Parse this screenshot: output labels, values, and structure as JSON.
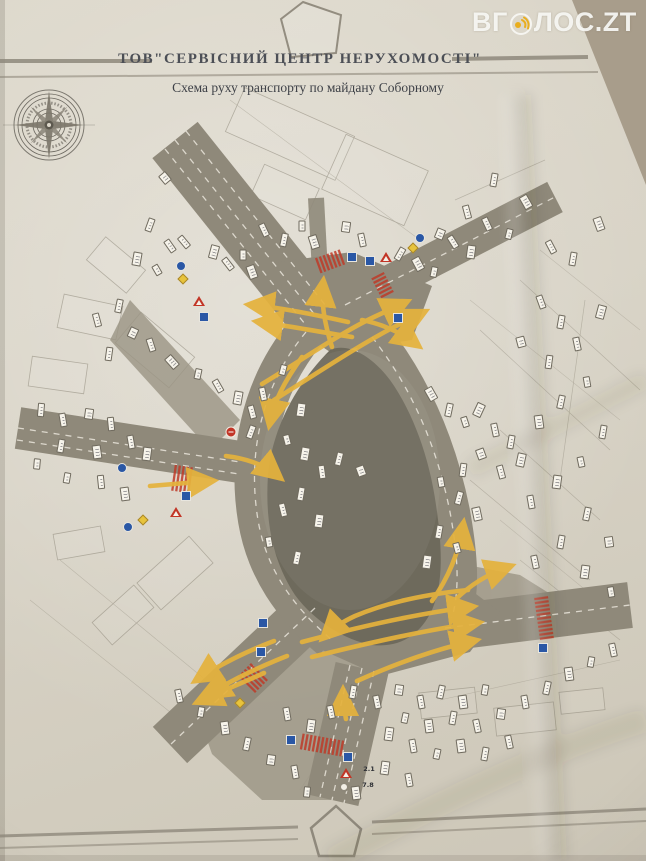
{
  "watermark": {
    "text_prefix": "ВГ",
    "text_suffix": "ЛОС.ZT",
    "icon": "megaphone-waves-icon",
    "text_color": "#f2f1ee",
    "icon_color": "#e9ae1e"
  },
  "header": {
    "company": "ТОВ\"СЕРВІСНИЙ ЦЕНТР НЕРУХОМОСТІ\"",
    "subtitle": "Схема руху транспорту по майдану Соборному"
  },
  "decorations": {
    "top_logo": "house-outline-icon",
    "bottom_logo": "house-outline-icon",
    "compass": "compass-rose-icon"
  },
  "colors": {
    "paper": "#d8d3c6",
    "paper-edge": "#a89d8b",
    "road": "#8f897a",
    "island": "#6e6a5c",
    "arrow": "#e5b23d",
    "crosswalk": "#bf3a28",
    "ink": "#4c4f56",
    "line": "#8d8779",
    "sign-blue": "#2a57a5",
    "sign-red": "#c23526",
    "sign-yellow": "#e7c33c",
    "marker-face": "#f6f3ea",
    "marker-edge": "#6f6a5e"
  },
  "map": {
    "readable_labels": [
      {
        "text": "2.1",
        "x": 369,
        "y": 769
      },
      {
        "text": "7.8",
        "x": 368,
        "y": 785
      }
    ],
    "traffic_signs": [
      {
        "type": "blue-circle",
        "x": 181,
        "y": 266
      },
      {
        "type": "yellow-diamond",
        "x": 183,
        "y": 279
      },
      {
        "type": "red-triangle",
        "x": 199,
        "y": 301
      },
      {
        "type": "blue-square",
        "x": 204,
        "y": 317
      },
      {
        "type": "blue-square",
        "x": 352,
        "y": 257
      },
      {
        "type": "blue-square",
        "x": 370,
        "y": 261
      },
      {
        "type": "red-triangle",
        "x": 386,
        "y": 257
      },
      {
        "type": "blue-square",
        "x": 398,
        "y": 318
      },
      {
        "type": "blue-circle",
        "x": 420,
        "y": 238
      },
      {
        "type": "yellow-diamond",
        "x": 413,
        "y": 248
      },
      {
        "type": "red-circle",
        "x": 231,
        "y": 432
      },
      {
        "type": "blue-square",
        "x": 186,
        "y": 496
      },
      {
        "type": "red-triangle",
        "x": 176,
        "y": 512
      },
      {
        "type": "yellow-diamond",
        "x": 143,
        "y": 520
      },
      {
        "type": "blue-circle",
        "x": 128,
        "y": 527
      },
      {
        "type": "blue-circle",
        "x": 122,
        "y": 468
      },
      {
        "type": "blue-square",
        "x": 263,
        "y": 623
      },
      {
        "type": "blue-square",
        "x": 261,
        "y": 652
      },
      {
        "type": "blue-square",
        "x": 543,
        "y": 648
      },
      {
        "type": "yellow-diamond",
        "x": 240,
        "y": 703
      },
      {
        "type": "blue-square",
        "x": 291,
        "y": 740
      },
      {
        "type": "blue-square",
        "x": 348,
        "y": 757
      },
      {
        "type": "red-triangle",
        "x": 346,
        "y": 773
      },
      {
        "type": "white-circle",
        "x": 344,
        "y": 787
      }
    ],
    "label_markers": [
      [
        165,
        178,
        -40
      ],
      [
        150,
        225,
        20
      ],
      [
        170,
        246,
        -35
      ],
      [
        137,
        259,
        10
      ],
      [
        157,
        270,
        -30
      ],
      [
        184,
        242,
        -40
      ],
      [
        214,
        252,
        15
      ],
      [
        228,
        264,
        -38
      ],
      [
        243,
        255,
        0
      ],
      [
        252,
        272,
        -20
      ],
      [
        119,
        306,
        12
      ],
      [
        97,
        320,
        -15
      ],
      [
        133,
        333,
        25
      ],
      [
        151,
        345,
        -18
      ],
      [
        109,
        354,
        8
      ],
      [
        172,
        362,
        -42
      ],
      [
        198,
        374,
        12
      ],
      [
        218,
        386,
        -30
      ],
      [
        238,
        398,
        10
      ],
      [
        252,
        412,
        -15
      ],
      [
        302,
        226,
        0
      ],
      [
        314,
        242,
        -18
      ],
      [
        284,
        240,
        12
      ],
      [
        264,
        230,
        -25
      ],
      [
        346,
        227,
        8
      ],
      [
        362,
        240,
        -12
      ],
      [
        400,
        254,
        30
      ],
      [
        418,
        264,
        -28
      ],
      [
        434,
        272,
        12
      ],
      [
        453,
        242,
        -32
      ],
      [
        471,
        252,
        8
      ],
      [
        487,
        224,
        -25
      ],
      [
        509,
        234,
        14
      ],
      [
        526,
        202,
        -30
      ],
      [
        494,
        180,
        10
      ],
      [
        467,
        212,
        -15
      ],
      [
        440,
        234,
        22
      ],
      [
        551,
        247,
        -28
      ],
      [
        573,
        259,
        10
      ],
      [
        599,
        224,
        -20
      ],
      [
        283,
        370,
        15
      ],
      [
        263,
        394,
        -12
      ],
      [
        301,
        410,
        8
      ],
      [
        251,
        432,
        20
      ],
      [
        287,
        440,
        -15
      ],
      [
        305,
        454,
        10
      ],
      [
        322,
        472,
        -8
      ],
      [
        339,
        459,
        14
      ],
      [
        361,
        471,
        -20
      ],
      [
        301,
        494,
        10
      ],
      [
        283,
        510,
        -14
      ],
      [
        319,
        521,
        8
      ],
      [
        269,
        542,
        -10
      ],
      [
        297,
        558,
        12
      ],
      [
        431,
        394,
        -30
      ],
      [
        449,
        410,
        12
      ],
      [
        465,
        422,
        -18
      ],
      [
        479,
        410,
        25
      ],
      [
        495,
        430,
        -12
      ],
      [
        511,
        442,
        10
      ],
      [
        481,
        454,
        -20
      ],
      [
        463,
        470,
        8
      ],
      [
        501,
        472,
        -15
      ],
      [
        521,
        460,
        12
      ],
      [
        441,
        482,
        -10
      ],
      [
        459,
        498,
        15
      ],
      [
        477,
        514,
        -12
      ],
      [
        439,
        532,
        10
      ],
      [
        457,
        548,
        -15
      ],
      [
        427,
        562,
        8
      ],
      [
        41,
        410,
        5
      ],
      [
        63,
        420,
        -10
      ],
      [
        89,
        414,
        8
      ],
      [
        111,
        424,
        -6
      ],
      [
        61,
        446,
        10
      ],
      [
        97,
        452,
        -8
      ],
      [
        37,
        464,
        5
      ],
      [
        131,
        442,
        -10
      ],
      [
        147,
        454,
        8
      ],
      [
        101,
        482,
        -6
      ],
      [
        67,
        478,
        10
      ],
      [
        125,
        494,
        -8
      ],
      [
        353,
        692,
        10
      ],
      [
        377,
        702,
        -12
      ],
      [
        399,
        690,
        8
      ],
      [
        421,
        702,
        -10
      ],
      [
        441,
        692,
        12
      ],
      [
        463,
        702,
        -8
      ],
      [
        485,
        690,
        10
      ],
      [
        331,
        712,
        -12
      ],
      [
        311,
        726,
        8
      ],
      [
        287,
        714,
        -10
      ],
      [
        405,
        718,
        12
      ],
      [
        429,
        726,
        -8
      ],
      [
        453,
        718,
        10
      ],
      [
        477,
        726,
        -12
      ],
      [
        501,
        714,
        8
      ],
      [
        525,
        702,
        -10
      ],
      [
        547,
        688,
        12
      ],
      [
        569,
        674,
        -8
      ],
      [
        591,
        662,
        10
      ],
      [
        613,
        650,
        -12
      ],
      [
        389,
        734,
        8
      ],
      [
        413,
        746,
        -10
      ],
      [
        437,
        754,
        12
      ],
      [
        461,
        746,
        -8
      ],
      [
        485,
        754,
        10
      ],
      [
        509,
        742,
        -12
      ],
      [
        271,
        760,
        8
      ],
      [
        295,
        772,
        -10
      ],
      [
        247,
        744,
        12
      ],
      [
        225,
        728,
        -8
      ],
      [
        201,
        712,
        10
      ],
      [
        179,
        696,
        -12
      ],
      [
        385,
        768,
        8
      ],
      [
        409,
        780,
        -10
      ],
      [
        307,
        792,
        6
      ],
      [
        356,
        793,
        -8
      ],
      [
        541,
        302,
        -20
      ],
      [
        561,
        322,
        10
      ],
      [
        521,
        342,
        -15
      ],
      [
        549,
        362,
        8
      ],
      [
        577,
        344,
        -12
      ],
      [
        601,
        312,
        15
      ],
      [
        587,
        382,
        -10
      ],
      [
        561,
        402,
        12
      ],
      [
        539,
        422,
        -8
      ],
      [
        603,
        432,
        10
      ],
      [
        581,
        462,
        -12
      ],
      [
        557,
        482,
        8
      ],
      [
        531,
        502,
        -10
      ],
      [
        587,
        514,
        12
      ],
      [
        609,
        542,
        -8
      ],
      [
        561,
        542,
        10
      ],
      [
        535,
        562,
        -12
      ],
      [
        585,
        572,
        8
      ],
      [
        611,
        592,
        -10
      ]
    ]
  }
}
